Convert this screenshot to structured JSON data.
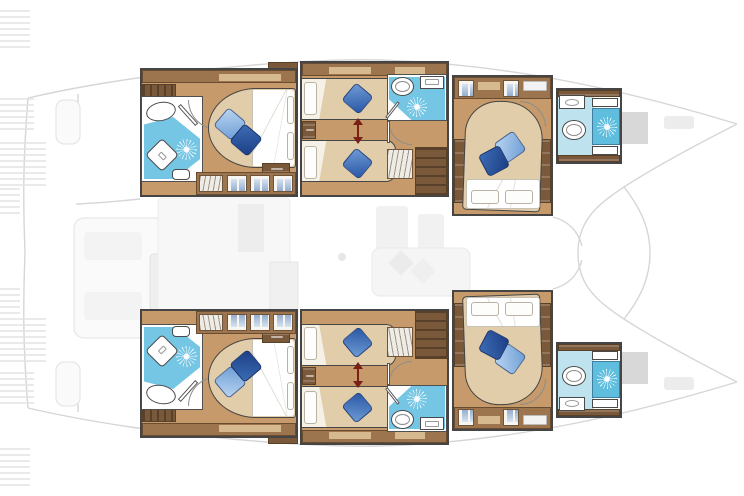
{
  "document": {
    "type": "boat-floor-plan",
    "subject": "catamaran sailing yacht - lower deck cabin layout with faded upper-deck overlay",
    "view": "top-down",
    "bow_direction": "right",
    "visible_text": []
  },
  "palette": {
    "outline": "#454545",
    "wood-floor": "#c69a6a",
    "wood-mid": "#9c744e",
    "wood-dark": "#7a583a",
    "wood-shelf": "#d6b98e",
    "mattress": "#e2cdaa",
    "bath-blue": "#74c6e4",
    "bath-pale": "#bfe2ef",
    "shower-blue": "#5fbede",
    "pillow-light-1": "#b9d4ee",
    "pillow-light-2": "#6f9fd8",
    "pillow-dark-1": "#3c6cb4",
    "pillow-dark-2": "#1d3f86",
    "arrow": "#7a1f15",
    "ghost-line": "#d6d6d6",
    "ghost-fill": "#f3f3f3",
    "hatch-gray": "#d8d8d8"
  },
  "hulls": [
    {
      "id": "port-hull",
      "position": "top",
      "cabins": [
        {
          "id": "aft-cabin",
          "beds": "1 double island bed",
          "pillows": [
            "light-blue",
            "dark-blue"
          ],
          "fixtures": [
            "staircase",
            "ensuite bathroom",
            "oval sink",
            "shower with sunburst drain",
            "shower pan",
            "toilet",
            "hanger locker",
            "3 garment lockers",
            "top shelf",
            "nightstand",
            "door"
          ]
        },
        {
          "id": "mid-cabin",
          "beds": "2 single beds, convertible (slide arrow between)",
          "pillows": [
            "blue",
            "blue"
          ],
          "fixtures": [
            "ensuite bathroom",
            "toilet",
            "sink counter",
            "shower with sunburst drain",
            "hanger locker",
            "companionway stairs",
            "nightstand",
            "doors",
            "top shelf"
          ]
        },
        {
          "id": "forward-cabin",
          "beds": "1 double bed, head aft",
          "pillows": [
            "light-blue",
            "dark-blue"
          ],
          "fixtures": [
            "2 garment lockers",
            "top shelves",
            "2 side tables",
            "door"
          ]
        },
        {
          "id": "bow-bathroom",
          "fixtures": [
            "sink counter",
            "toilet",
            "shower with sunburst drain",
            "2 shelves"
          ]
        }
      ]
    },
    {
      "id": "starboard-hull",
      "position": "bottom",
      "mirror_of": "port-hull"
    }
  ],
  "deck_ghost": {
    "style": "faded light-gray overlay of deck above",
    "elements": [
      "transom steps (striped, left edge)",
      "engine hatches",
      "cockpit seating",
      "cockpit table",
      "salon furniture",
      "saloon sofa with 2 cushions",
      "foredeck hatches (gray)",
      "windlass",
      "twin bow outline to pointed tips"
    ]
  }
}
